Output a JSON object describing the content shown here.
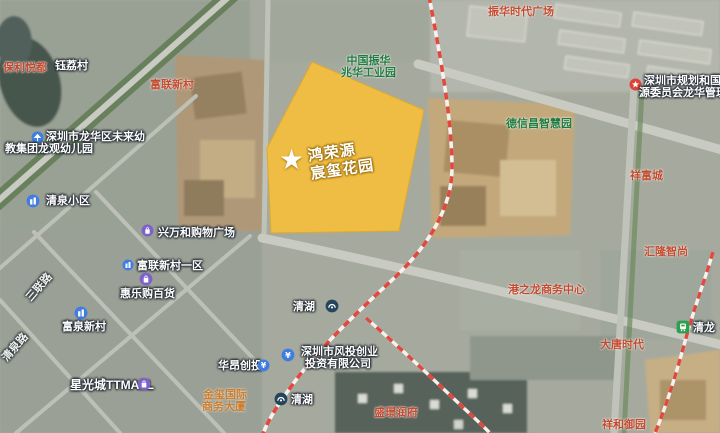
{
  "map": {
    "kind": "satellite-map-screenshot",
    "city_district": "深圳市龙华区清湖"
  },
  "colors": {
    "highlight_fill": "#F4BE3C",
    "highlight_stroke": "#DFA92F",
    "railway_red": "#E2483D",
    "poi_red": "#C24A2E",
    "poi_green": "#1F7A3F",
    "metro_icon_bg": "#25455C",
    "tram_icon_bg": "#2E9E4F",
    "shopping_icon_bg": "#7D62C9",
    "estate_icon_bg": "#3F7DE0",
    "gov_icon_bg": "#E04238"
  },
  "highlight": {
    "developer": "鸿荣源",
    "project": "宸玺花园",
    "marker": "★"
  },
  "labels": {
    "baoli_yuedu": "保利悦都",
    "yuli_village": "钰荔村",
    "fulian_xincun_north": "富联新村",
    "zhenhua_plaza": "振华时代广场",
    "zhenhua_line1": "中国振华",
    "zhenhua_line2": "兆华工业园",
    "planning_bureau_line1": "深圳市规划和国土资",
    "planning_bureau_line2": "源委员会龙华管理局",
    "dexinchang_park": "德信昌智慧园",
    "xiangfu_city": "祥富城",
    "kindergarten_line1": "深圳市龙华区未来幼",
    "kindergarten_line2": "教集团龙观幼儿园",
    "qingquan_estate": "清泉小区",
    "xingwanhe_mall": "兴万和购物广场",
    "fulian_district1": "富联新村一区",
    "huilegou_store": "惠乐购百货",
    "fuquan_xincun": "富泉新村",
    "sanlian_road": "三联路",
    "qingquan_road": "清泉路",
    "starlight_mall": "星光城TTMALL",
    "jinxi_line1": "金玺国际",
    "jinxi_line2": "商务大厦",
    "huaang_vc": "华昂创投",
    "fengtou_line1": "深圳市风投创业",
    "fengtou_line2": "投资有限公司",
    "qinghu_station_mid": "清湖",
    "qinghu_station_south": "清湖",
    "shengjing_mansion": "盛璟润府",
    "datang_times": "大唐时代",
    "gangzhilong_center": "港之龙商务中心",
    "huilong_zhishang": "汇隆智尚",
    "qinglong_station": "清龙",
    "xianghe_mansion": "祥和御园"
  }
}
